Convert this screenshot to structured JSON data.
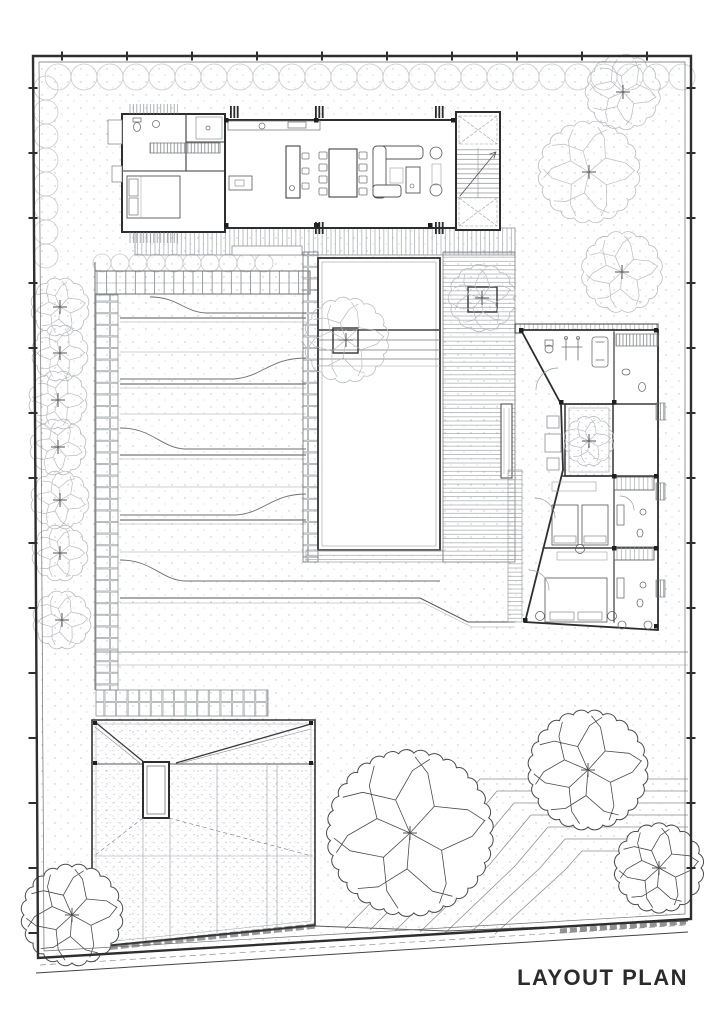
{
  "title": {
    "label": "LAYOUT PLAN"
  },
  "palette": {
    "paper": "#ffffff",
    "ink": "#2e2e2e",
    "wall": "#3a3a3a",
    "mid": "#6f6f6f",
    "light": "#9aa0a4",
    "faint": "#c6c9cd",
    "tree_dark": "#4a4a4a",
    "tree_faint": "#b9bcbf",
    "cross": "#555555"
  },
  "plan": {
    "trees": {
      "detailed": [
        {
          "x": 410,
          "y": 833,
          "r": 80
        },
        {
          "x": 588,
          "y": 770,
          "r": 57
        },
        {
          "x": 659,
          "y": 868,
          "r": 42
        },
        {
          "x": 72,
          "y": 915,
          "r": 48
        }
      ],
      "faint": [
        {
          "x": 623,
          "y": 92,
          "r": 35
        },
        {
          "x": 589,
          "y": 172,
          "r": 48
        },
        {
          "x": 622,
          "y": 272,
          "r": 38
        },
        {
          "x": 346,
          "y": 340,
          "r": 40
        },
        {
          "x": 482,
          "y": 298,
          "r": 31
        },
        {
          "x": 589,
          "y": 441,
          "r": 23
        }
      ],
      "row_left": [
        {
          "x": 60,
          "y": 307,
          "r": 27
        },
        {
          "x": 60,
          "y": 353,
          "r": 26
        },
        {
          "x": 58,
          "y": 400,
          "r": 27
        },
        {
          "x": 58,
          "y": 447,
          "r": 26
        },
        {
          "x": 60,
          "y": 500,
          "r": 27
        },
        {
          "x": 60,
          "y": 553,
          "r": 26
        },
        {
          "x": 62,
          "y": 620,
          "r": 27
        }
      ]
    },
    "hedges": [
      {
        "orient": "h",
        "x0": 58,
        "x1": 684,
        "y": 77,
        "r": 13,
        "step": 26
      },
      {
        "orient": "v",
        "x": 46,
        "y0": 88,
        "y1": 258,
        "r": 12,
        "step": 24
      },
      {
        "orient": "h",
        "x0": 102,
        "x1": 276,
        "y": 263,
        "r": 9,
        "step": 18
      }
    ],
    "boundary_ticks": [
      {
        "x0": 62,
        "y0": 56,
        "x1": 676,
        "y1": 56,
        "step": 65,
        "len": 9,
        "dir": "v"
      },
      {
        "x0": 691,
        "y0": 88,
        "x1": 691,
        "y1": 900,
        "step": 65,
        "len": 9,
        "dir": "h"
      },
      {
        "x0": 33,
        "y0": 88,
        "x1": 33,
        "y1": 945,
        "step": 65,
        "len": 9,
        "dir": "h"
      }
    ]
  }
}
